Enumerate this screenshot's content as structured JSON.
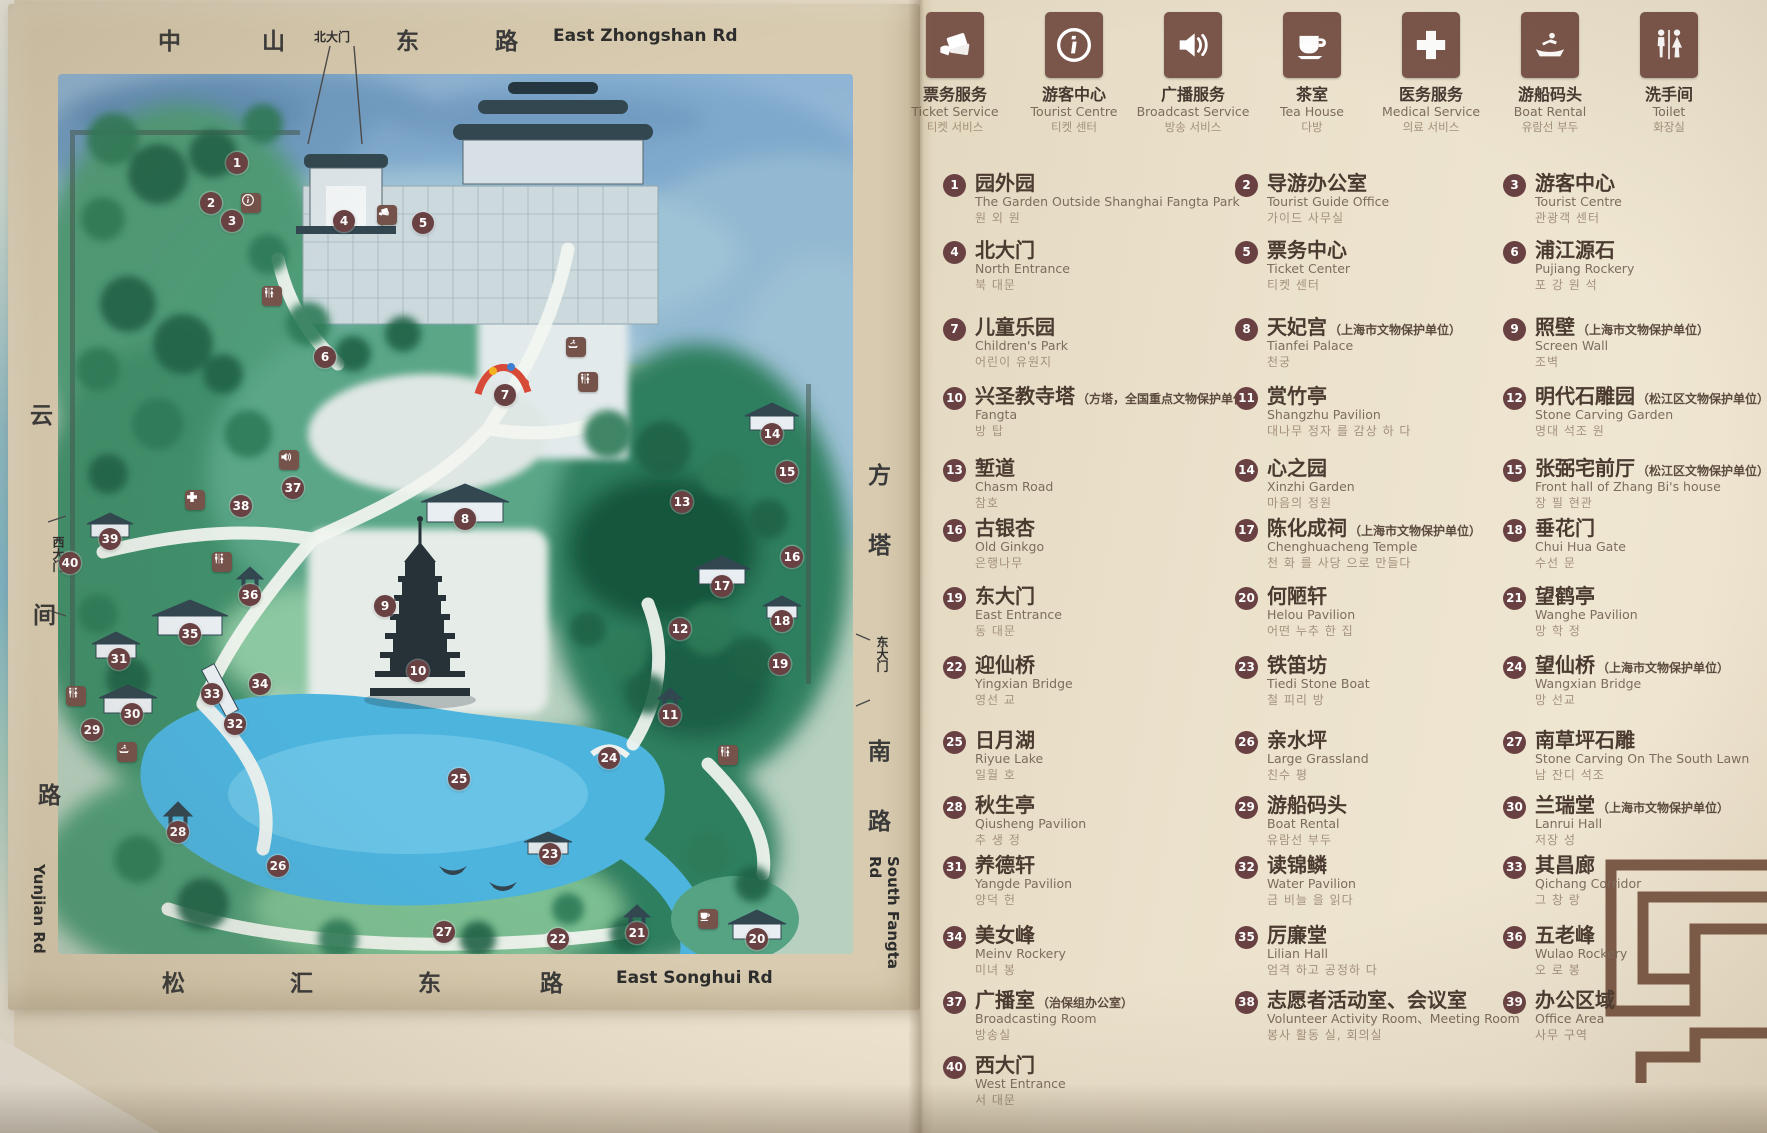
{
  "map": {
    "roads": {
      "top": {
        "chars": [
          "中",
          "山",
          "东",
          "路"
        ],
        "en": "East Zhongshan Rd",
        "gate": "北大门"
      },
      "bottom": {
        "chars": [
          "松",
          "汇",
          "东",
          "路"
        ],
        "en": "East Songhui Rd"
      },
      "left": {
        "chars": [
          "云",
          "间",
          "路"
        ],
        "en": "Yunjian Rd",
        "gate": "西大门"
      },
      "right": {
        "chars": [
          "方",
          "塔",
          "南",
          "路"
        ],
        "en": "South Fangta Rd",
        "gate": "东大门"
      }
    },
    "markers": [
      {
        "n": "1",
        "x": 229,
        "y": 159
      },
      {
        "n": "2",
        "x": 203,
        "y": 199
      },
      {
        "n": "3",
        "x": 224,
        "y": 217
      },
      {
        "n": "4",
        "x": 336,
        "y": 217
      },
      {
        "n": "5",
        "x": 415,
        "y": 219
      },
      {
        "n": "6",
        "x": 317,
        "y": 353
      },
      {
        "n": "7",
        "x": 497,
        "y": 391
      },
      {
        "n": "8",
        "x": 457,
        "y": 515
      },
      {
        "n": "9",
        "x": 377,
        "y": 602
      },
      {
        "n": "10",
        "x": 410,
        "y": 667
      },
      {
        "n": "11",
        "x": 662,
        "y": 711
      },
      {
        "n": "12",
        "x": 672,
        "y": 625
      },
      {
        "n": "13",
        "x": 674,
        "y": 498
      },
      {
        "n": "14",
        "x": 764,
        "y": 430
      },
      {
        "n": "15",
        "x": 779,
        "y": 468
      },
      {
        "n": "16",
        "x": 784,
        "y": 553
      },
      {
        "n": "17",
        "x": 714,
        "y": 582
      },
      {
        "n": "18",
        "x": 774,
        "y": 617
      },
      {
        "n": "19",
        "x": 772,
        "y": 660
      },
      {
        "n": "20",
        "x": 749,
        "y": 935
      },
      {
        "n": "21",
        "x": 629,
        "y": 929
      },
      {
        "n": "22",
        "x": 550,
        "y": 935
      },
      {
        "n": "23",
        "x": 542,
        "y": 850
      },
      {
        "n": "24",
        "x": 601,
        "y": 754
      },
      {
        "n": "25",
        "x": 451,
        "y": 775
      },
      {
        "n": "26",
        "x": 270,
        "y": 862
      },
      {
        "n": "27",
        "x": 436,
        "y": 928
      },
      {
        "n": "28",
        "x": 170,
        "y": 828
      },
      {
        "n": "29",
        "x": 84,
        "y": 726
      },
      {
        "n": "30",
        "x": 124,
        "y": 710
      },
      {
        "n": "31",
        "x": 111,
        "y": 655
      },
      {
        "n": "32",
        "x": 227,
        "y": 720
      },
      {
        "n": "33",
        "x": 204,
        "y": 690
      },
      {
        "n": "34",
        "x": 252,
        "y": 680
      },
      {
        "n": "35",
        "x": 182,
        "y": 630
      },
      {
        "n": "36",
        "x": 242,
        "y": 591
      },
      {
        "n": "37",
        "x": 285,
        "y": 484
      },
      {
        "n": "38",
        "x": 233,
        "y": 502
      },
      {
        "n": "39",
        "x": 102,
        "y": 535
      },
      {
        "n": "40",
        "x": 62,
        "y": 559
      }
    ],
    "icons": [
      {
        "type": "info",
        "x": 243,
        "y": 199
      },
      {
        "type": "ticket",
        "x": 379,
        "y": 211
      },
      {
        "type": "toilet",
        "x": 264,
        "y": 292
      },
      {
        "type": "boat",
        "x": 568,
        "y": 343
      },
      {
        "type": "toilet",
        "x": 580,
        "y": 378
      },
      {
        "type": "speaker",
        "x": 281,
        "y": 456
      },
      {
        "type": "medical",
        "x": 187,
        "y": 496
      },
      {
        "type": "toilet",
        "x": 214,
        "y": 558
      },
      {
        "type": "toilet",
        "x": 68,
        "y": 692
      },
      {
        "type": "boat",
        "x": 119,
        "y": 748
      },
      {
        "type": "toilet",
        "x": 720,
        "y": 751
      },
      {
        "type": "tea",
        "x": 700,
        "y": 915
      }
    ]
  },
  "legend": {
    "services": [
      {
        "key": "ticket",
        "zh": "票务服务",
        "en": "Ticket Service",
        "ko": "티켓 서비스"
      },
      {
        "key": "info",
        "zh": "游客中心",
        "en": "Tourist Centre",
        "ko": "티켓 센터"
      },
      {
        "key": "speaker",
        "zh": "广播服务",
        "en": "Broadcast Service",
        "ko": "방송 서비스"
      },
      {
        "key": "tea",
        "zh": "茶室",
        "en": "Tea House",
        "ko": "다방"
      },
      {
        "key": "medical",
        "zh": "医务服务",
        "en": "Medical Service",
        "ko": "의료 서비스"
      },
      {
        "key": "boat",
        "zh": "游船码头",
        "en": "Boat Rental",
        "ko": "유람선 부두"
      },
      {
        "key": "toilet",
        "zh": "洗手间",
        "en": "Toilet",
        "ko": "화장실"
      }
    ],
    "items": [
      {
        "n": "1",
        "zh": "园外园",
        "note": "",
        "en": "The Garden Outside Shanghai Fangta Park",
        "ko": "원 외 원"
      },
      {
        "n": "2",
        "zh": "导游办公室",
        "note": "",
        "en": "Tourist Guide Office",
        "ko": "가이드 사무실"
      },
      {
        "n": "3",
        "zh": "游客中心",
        "note": "",
        "en": "Tourist Centre",
        "ko": "관광객 센터"
      },
      {
        "n": "4",
        "zh": "北大门",
        "note": "",
        "en": "North Entrance",
        "ko": "북 대문"
      },
      {
        "n": "5",
        "zh": "票务中心",
        "note": "",
        "en": "Ticket Center",
        "ko": "티켓 센터"
      },
      {
        "n": "6",
        "zh": "浦江源石",
        "note": "",
        "en": "Pujiang Rockery",
        "ko": "포 강 원 석"
      },
      {
        "n": "7",
        "zh": "儿童乐园",
        "note": "",
        "en": "Children's Park",
        "ko": "어린이 유원지"
      },
      {
        "n": "8",
        "zh": "天妃宫",
        "note": "（上海市文物保护单位）",
        "en": "Tianfei Palace",
        "ko": "천궁"
      },
      {
        "n": "9",
        "zh": "照壁",
        "note": "（上海市文物保护单位）",
        "en": "Screen Wall",
        "ko": "조벽"
      },
      {
        "n": "10",
        "zh": "兴圣教寺塔",
        "note": "（方塔，全国重点文物保护单位）",
        "en": "Fangta",
        "ko": "방 탑"
      },
      {
        "n": "11",
        "zh": "赏竹亭",
        "note": "",
        "en": "Shangzhu Pavilion",
        "ko": "대나무 정자 를 감상 하 다"
      },
      {
        "n": "12",
        "zh": "明代石雕园",
        "note": "（松江区文物保护单位）",
        "en": "Stone Carving Garden",
        "ko": "명대 석조 원"
      },
      {
        "n": "13",
        "zh": "堑道",
        "note": "",
        "en": "Chasm Road",
        "ko": "참호"
      },
      {
        "n": "14",
        "zh": "心之园",
        "note": "",
        "en": "Xinzhi Garden",
        "ko": "마음의 정원"
      },
      {
        "n": "15",
        "zh": "张弼宅前厅",
        "note": "（松江区文物保护单位）",
        "en": "Front hall of Zhang Bi's house",
        "ko": "장 필 현관"
      },
      {
        "n": "16",
        "zh": "古银杏",
        "note": "",
        "en": "Old Ginkgo",
        "ko": "은행나무"
      },
      {
        "n": "17",
        "zh": "陈化成祠",
        "note": "（上海市文物保护单位）",
        "en": "Chenghuacheng Temple",
        "ko": "천 화 를 사당 으로 만들다"
      },
      {
        "n": "18",
        "zh": "垂花门",
        "note": "",
        "en": "Chui Hua Gate",
        "ko": "수선 문"
      },
      {
        "n": "19",
        "zh": "东大门",
        "note": "",
        "en": "East Entrance",
        "ko": "동 대문"
      },
      {
        "n": "20",
        "zh": "何陋轩",
        "note": "",
        "en": "Helou Pavilion",
        "ko": "어떤 누추 한 집"
      },
      {
        "n": "21",
        "zh": "望鹤亭",
        "note": "",
        "en": "Wanghe Pavilion",
        "ko": "망 학 정"
      },
      {
        "n": "22",
        "zh": "迎仙桥",
        "note": "",
        "en": "Yingxian Bridge",
        "ko": "영선 교"
      },
      {
        "n": "23",
        "zh": "铁笛坊",
        "note": "",
        "en": "Tiedi Stone Boat",
        "ko": "철 피리 방"
      },
      {
        "n": "24",
        "zh": "望仙桥",
        "note": "（上海市文物保护单位）",
        "en": "Wangxian Bridge",
        "ko": "망 선교"
      },
      {
        "n": "25",
        "zh": "日月湖",
        "note": "",
        "en": "Riyue Lake",
        "ko": "일월 호"
      },
      {
        "n": "26",
        "zh": "亲水坪",
        "note": "",
        "en": "Large Grassland",
        "ko": "친수 평"
      },
      {
        "n": "27",
        "zh": "南草坪石雕",
        "note": "",
        "en": "Stone Carving On The South Lawn",
        "ko": "남 잔디 석조"
      },
      {
        "n": "28",
        "zh": "秋生亭",
        "note": "",
        "en": "Qiusheng Pavilion",
        "ko": "추 생 정"
      },
      {
        "n": "29",
        "zh": "游船码头",
        "note": "",
        "en": "Boat Rental",
        "ko": "유람선 부두"
      },
      {
        "n": "30",
        "zh": "兰瑞堂",
        "note": "（上海市文物保护单位）",
        "en": "Lanrui Hall",
        "ko": "저장 성"
      },
      {
        "n": "31",
        "zh": "养德轩",
        "note": "",
        "en": "Yangde Pavilion",
        "ko": "양덕 헌"
      },
      {
        "n": "32",
        "zh": "读锦鳞",
        "note": "",
        "en": "Water Pavilion",
        "ko": "금 비늘 을 읽다"
      },
      {
        "n": "33",
        "zh": "其昌廊",
        "note": "",
        "en": "Qichang Corridor",
        "ko": "그 창 랑"
      },
      {
        "n": "34",
        "zh": "美女峰",
        "note": "",
        "en": "Meinv Rockery",
        "ko": "미녀 봉"
      },
      {
        "n": "35",
        "zh": "厉廉堂",
        "note": "",
        "en": "Lilian Hall",
        "ko": "엄격 하고 공정하 다"
      },
      {
        "n": "36",
        "zh": "五老峰",
        "note": "",
        "en": "Wulao Rockery",
        "ko": "오 로 봉"
      },
      {
        "n": "37",
        "zh": "广播室",
        "note": "（治保组办公室）",
        "en": "Broadcasting Room",
        "ko": "방송실"
      },
      {
        "n": "38",
        "zh": "志愿者活动室、会议室",
        "note": "",
        "en": "Volunteer Activity Room、Meeting Room",
        "ko": "봉사 활동 실, 회의실"
      },
      {
        "n": "39",
        "zh": "办公区域",
        "note": "",
        "en": "Office Area",
        "ko": "사무 구역"
      },
      {
        "n": "40",
        "zh": "西大门",
        "note": "",
        "en": "West Entrance",
        "ko": "서 대문"
      }
    ]
  },
  "colors": {
    "marker": "#6a4143",
    "icon_square": "#75524a",
    "paper": "#eae0ca",
    "board": "#d8cbaf",
    "ornament": "#7d5b49"
  }
}
